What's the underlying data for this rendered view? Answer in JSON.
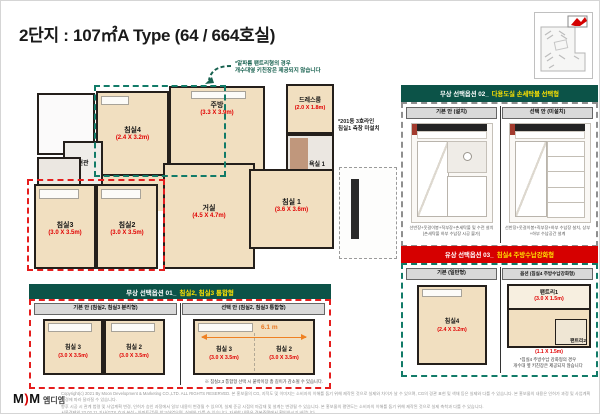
{
  "page": {
    "title": "2단지 : 107㎡A Type (64 / 664호실)"
  },
  "notes": {
    "kitchen_line1": "*알파룸 팬트리형의 경우",
    "kitchen_line2": "개수대옆 키친장은 제공되지 않습니다",
    "window_line1": "*201동 3호라인",
    "window_line2": "침실1 측창 미설치"
  },
  "plan": {
    "bedroom4": {
      "name": "침실4",
      "dim": "(2.4 X 3.2m)"
    },
    "kitchen": {
      "name": "주방",
      "dim": "(3.3 X 3.9m)"
    },
    "dressroom": {
      "name": "드레스룸",
      "dim": "(2.0 X 1.8m)"
    },
    "bath1": {
      "name": "욕실 1"
    },
    "bath2": {
      "name": "욕실2"
    },
    "entrance": {
      "name": "현관"
    },
    "bedroom1": {
      "name": "침실 1",
      "dim": "(3.6 X 3.6m)"
    },
    "living": {
      "name": "거실",
      "dim": "(4.5 X 4.7m)"
    },
    "bedroom3": {
      "name": "침실3",
      "dim": "(3.0 X 3.5m)"
    },
    "bedroom2": {
      "name": "침실2",
      "dim": "(3.0 X 3.5m)"
    }
  },
  "option1": {
    "header_prefix": "무상 선택옵션 01_",
    "header_highlight": "침실2, 침실3 통합형",
    "col_left": "기본 안 (침실2, 침실3 분리형)",
    "col_right": "선택 안 (침실2, 침실3 통합형)",
    "left_room_a": {
      "name": "침실 3",
      "dim": "(3.0 X 3.5m)"
    },
    "left_room_b": {
      "name": "침실 2",
      "dim": "(3.0 X 3.5m)"
    },
    "right_room_a": {
      "name": "침실 3",
      "dim": "(3.0 X 3.5m)"
    },
    "right_room_b": {
      "name": "침실 2",
      "dim": "(3.0 X 3.5m)"
    },
    "dimension": "6.1 m",
    "footnote": "※ 침실2,3 통합형 선택 시 붙박이장 총 길이가 감소될 수 있습니다."
  },
  "option2": {
    "header_prefix": "무상 선택옵션 02_",
    "header_highlight": "다용도실 손세탁볼 선택형",
    "col_left": "기본 안 (설치)",
    "col_right": "선택 안 (미설치)",
    "caption_left": "선반장+옷걸이봉+직부장+손세탁볼 및 수전 설치 (손세탁볼 하부 수납장 시공 불가)",
    "caption_right": "선반장+옷걸이봉+직부장+하부 수납장 설치, 상부+하부 수납공간 설계"
  },
  "option3": {
    "header_prefix": "유상 선택옵션 03_",
    "header_highlight": "침실4 주방수납강화형",
    "col_left": "기본 (일반형)",
    "col_right": "옵션 (침실4 주방수납강화형)",
    "basic_room": {
      "name": "침실4",
      "dim": "(2.4 X 3.2m)"
    },
    "pantry1": {
      "name": "팬트리1",
      "dim": "(3.0 X 1.5m)"
    },
    "pantry2": {
      "name": "팬트리2",
      "dim": "(1.1 X 1.5m)"
    },
    "note_line1": "*침실4 주방수납 강화형의 경우",
    "note_line2": "개수대 옆 키친장은 제공되지 않습니다"
  },
  "footer": {
    "logo_m1": "M",
    "logo_mark": ")",
    "logo_m2": "M",
    "logo_name": "엠디엠",
    "copyright1": "Copyright(c) 2021 By Moon Development & Marketing CO.,LTD. ALL RIGHTS RESERVED. 본 홍보물의 CG, 지적도 및 이미지는 소비자의 이해를 돕기 위해 제작된 것으로 실제와 차이가 날 수 있으며, CG의 경관 표현 및 색채 등은 실제와 다를 수 있습니다. 본 홍보물의 내용은 인허가 과정 및 사업계획 변경에 따라 달라질 수 있습니다.",
    "copyright2": "향후 시공 시 관계 법령 및 사업계획 변경, 인허가 승인 과정에서 일부 내용이 변경될 수 있으며, 실제 준공 시점의 마감재 및 설계는 변경될 수 있습니다. 본 홍보물의 평면도는 소비자의 이해를 돕기 위해 제작된 것으로 실제 축척과 다를 수 있습니다.",
    "copyright3": "서울경제외 22.02.11 기사(GTX 효과 분석 - 아파트값)을 참고하였으며, 실제와 다를 수 있습니다. 자세한 내용은 견본주택에서 확인하시기 바랍니다."
  },
  "colors": {
    "teal_header": "#0c5348",
    "red_header": "#d60000",
    "highlight_yellow": "#ffe300",
    "dim_red": "#e10000",
    "floor_beige": "#f1dfc0",
    "wall_dark": "#241f1b",
    "teal_dash": "#127b68",
    "red_dash": "#e51d1d",
    "orange_arrow": "#ef8123"
  }
}
